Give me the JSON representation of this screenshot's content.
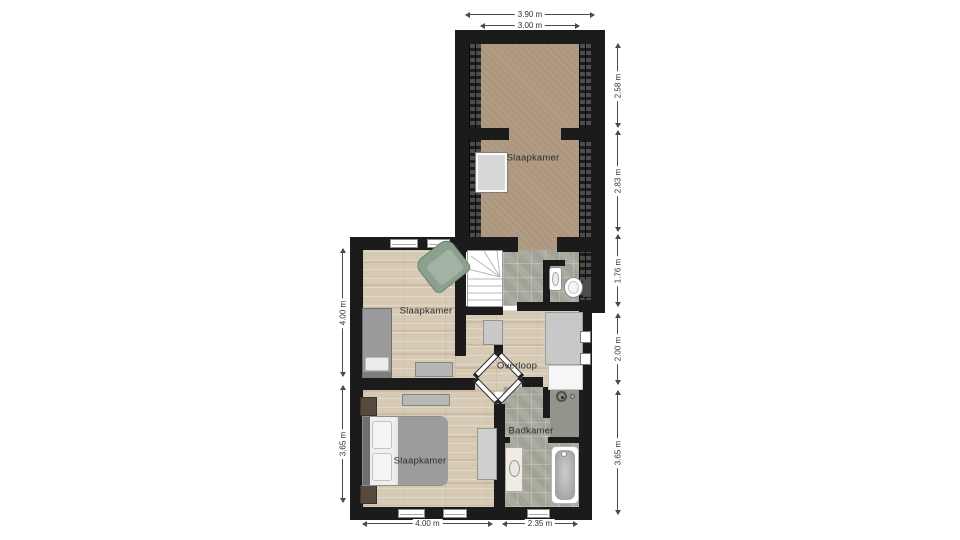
{
  "rooms": {
    "attic_bedroom": {
      "label": "Slaapkamer"
    },
    "middle_bedroom": {
      "label": "Slaapkamer"
    },
    "bottom_bedroom": {
      "label": "Slaapkamer"
    },
    "landing": {
      "label": "Overloop"
    },
    "bathroom": {
      "label": "Badkamer"
    }
  },
  "dimensions": {
    "top": [
      {
        "label": "3.90 m"
      },
      {
        "label": "3.00 m"
      }
    ],
    "right": [
      {
        "label": "2.58 m"
      },
      {
        "label": "2.83 m"
      },
      {
        "label": "1.76 m"
      },
      {
        "label": "2.00 m"
      },
      {
        "label": "3.65 m"
      }
    ],
    "left": [
      {
        "label": "4.00 m"
      },
      {
        "label": "3.65 m"
      }
    ],
    "bottom": [
      {
        "label": "4.00 m"
      },
      {
        "label": "2.35 m"
      }
    ]
  },
  "colors": {
    "wall": "#1b1b1b",
    "carpet_floor": "#b29b83",
    "wood_floor": "#d7cab5",
    "tile_floor": "#abab9f",
    "shower_tile": "#94948b",
    "background": "#ffffff",
    "dimension_line": "#4a4a4a"
  }
}
